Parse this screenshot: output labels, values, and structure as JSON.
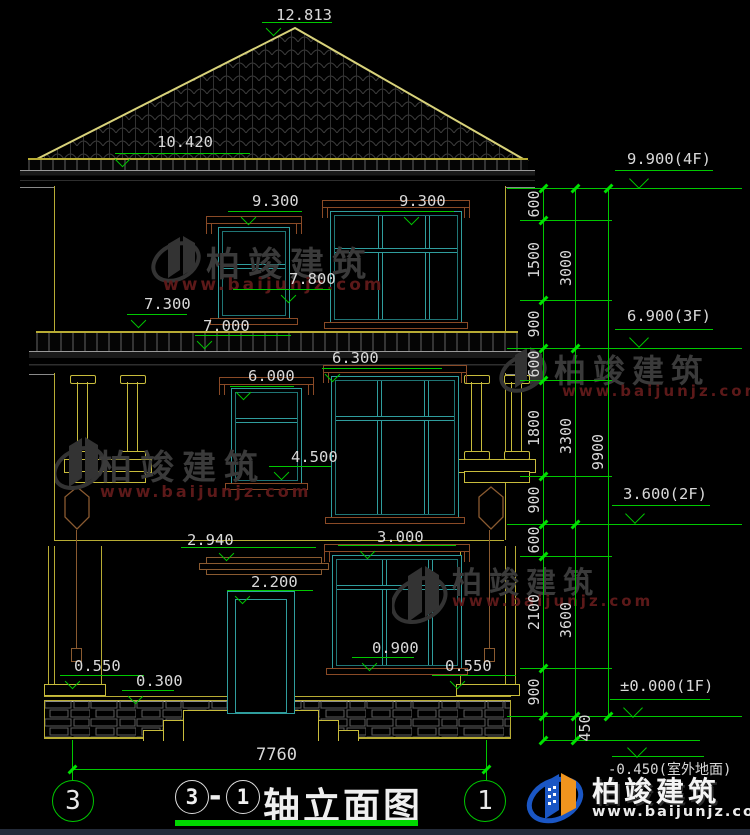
{
  "drawing": {
    "marks": {
      "peak": "12.813",
      "eave": "10.420",
      "win3_left": "9.300",
      "win3_right": "9.300",
      "win3_left_sill": "7.800",
      "band_upper": "7.300",
      "band_lower": "7.000",
      "win2_left_top": "6.000",
      "win2_right_top": "6.300",
      "win2_left_sill": "4.500",
      "canopy": "2.940",
      "win1_right_top": "3.000",
      "door_top": "2.200",
      "win1_right_sill": "0.900",
      "pedestal_left": "0.550",
      "plinth": "0.300",
      "pedestal_right": "0.550"
    },
    "levels": {
      "f4": "9.900(4F)",
      "f3": "6.900(3F)",
      "f2": "3.600(2F)",
      "f1": "±0.000(1F)",
      "ground": "-0.450(室外地面)"
    },
    "dims": {
      "inner": [
        "600",
        "1500",
        "900",
        "600",
        "1800",
        "900",
        "600",
        "2100",
        "900"
      ],
      "floors": [
        "3000",
        "3300",
        "3600"
      ],
      "overall": "9900",
      "outdoor_drop": "450",
      "width": "7760"
    },
    "axes": {
      "left": "3",
      "right": "1"
    }
  },
  "title": {
    "bubble_left": "3",
    "dash": "-",
    "bubble_right": "1",
    "text": "轴立面图"
  },
  "watermark": {
    "brand": "柏竣建筑",
    "url": "www.baijunjz.com"
  },
  "logo": {
    "brand": "柏竣建筑",
    "url": "www.baijunjz.com"
  }
}
